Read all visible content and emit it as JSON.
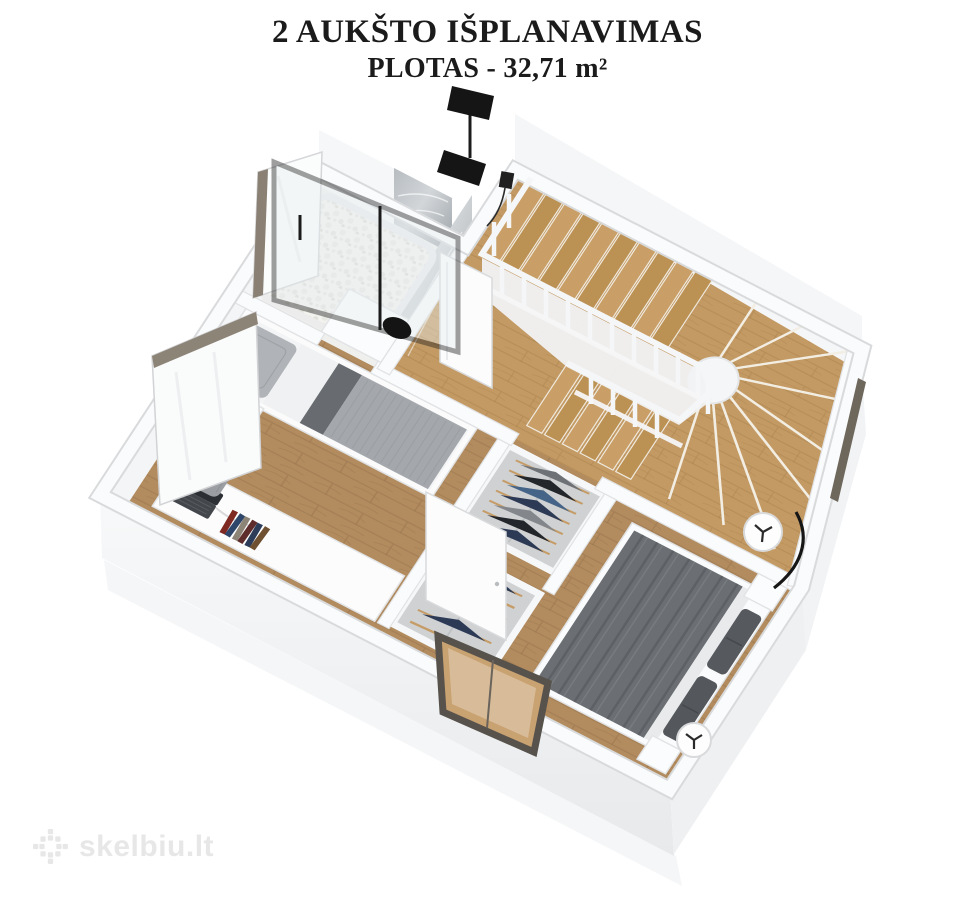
{
  "header": {
    "title": "2 AUKŠTO IŠPLANAVIMAS",
    "subtitle": "PLOTAS - 32,71 m²"
  },
  "watermark": {
    "text": "skelbiu.lt",
    "icon": "skelbiu-flower-icon",
    "color": "#e7e7e7"
  },
  "floorplan": {
    "type": "3d-isometric-floor-plan",
    "floor_label": "2 aukštas",
    "area_m2": "32,71",
    "rooms": [
      {
        "name": "bathroom",
        "features": [
          "walk-in shower with black framed glass",
          "black rain shower head",
          "marble accent wall",
          "white pebble shower floor",
          "white vanity with black basin"
        ]
      },
      {
        "name": "staircase",
        "features": [
          "wooden winder treads",
          "white balustrade with posts",
          "white curved stringer wall"
        ]
      },
      {
        "name": "single-bedroom",
        "features": [
          "single bed with gray bedding",
          "white nightstand",
          "green plant",
          "black table lamp",
          "white desk with laptop and books",
          "gray upholstered chair",
          "leaning window panels"
        ]
      },
      {
        "name": "wardrobe-corridor",
        "features": [
          "two open wardrobe units",
          "clothes on wooden hangers",
          "two white doors ajar"
        ]
      },
      {
        "name": "master-bedroom",
        "features": [
          "double bed with dark gray duvet",
          "two dark gray pillows",
          "two white cylinder lamps",
          "black curved floor lamp",
          "dark framed low window"
        ]
      }
    ],
    "colors": {
      "background": "#ffffff",
      "wall_top": "#fafbfc",
      "wall_edge": "#d8dadc",
      "wall_face": "#eef0f2",
      "floor_wood": "#b28b5e",
      "stair_wood": "#c79e68",
      "bathroom_floor": "#f1f1ee",
      "marble": "#aeb3b8",
      "glass_frame": "#1b1b1b",
      "window_trim": "#877e6f",
      "duvet_dark": "#6b6f73",
      "duvet_light": "#a4a8ac",
      "clothes_navy": "#2c3a55",
      "hanger_wood": "#c69c66",
      "plant_green": "#467234",
      "text": "#1b1b1b"
    }
  }
}
